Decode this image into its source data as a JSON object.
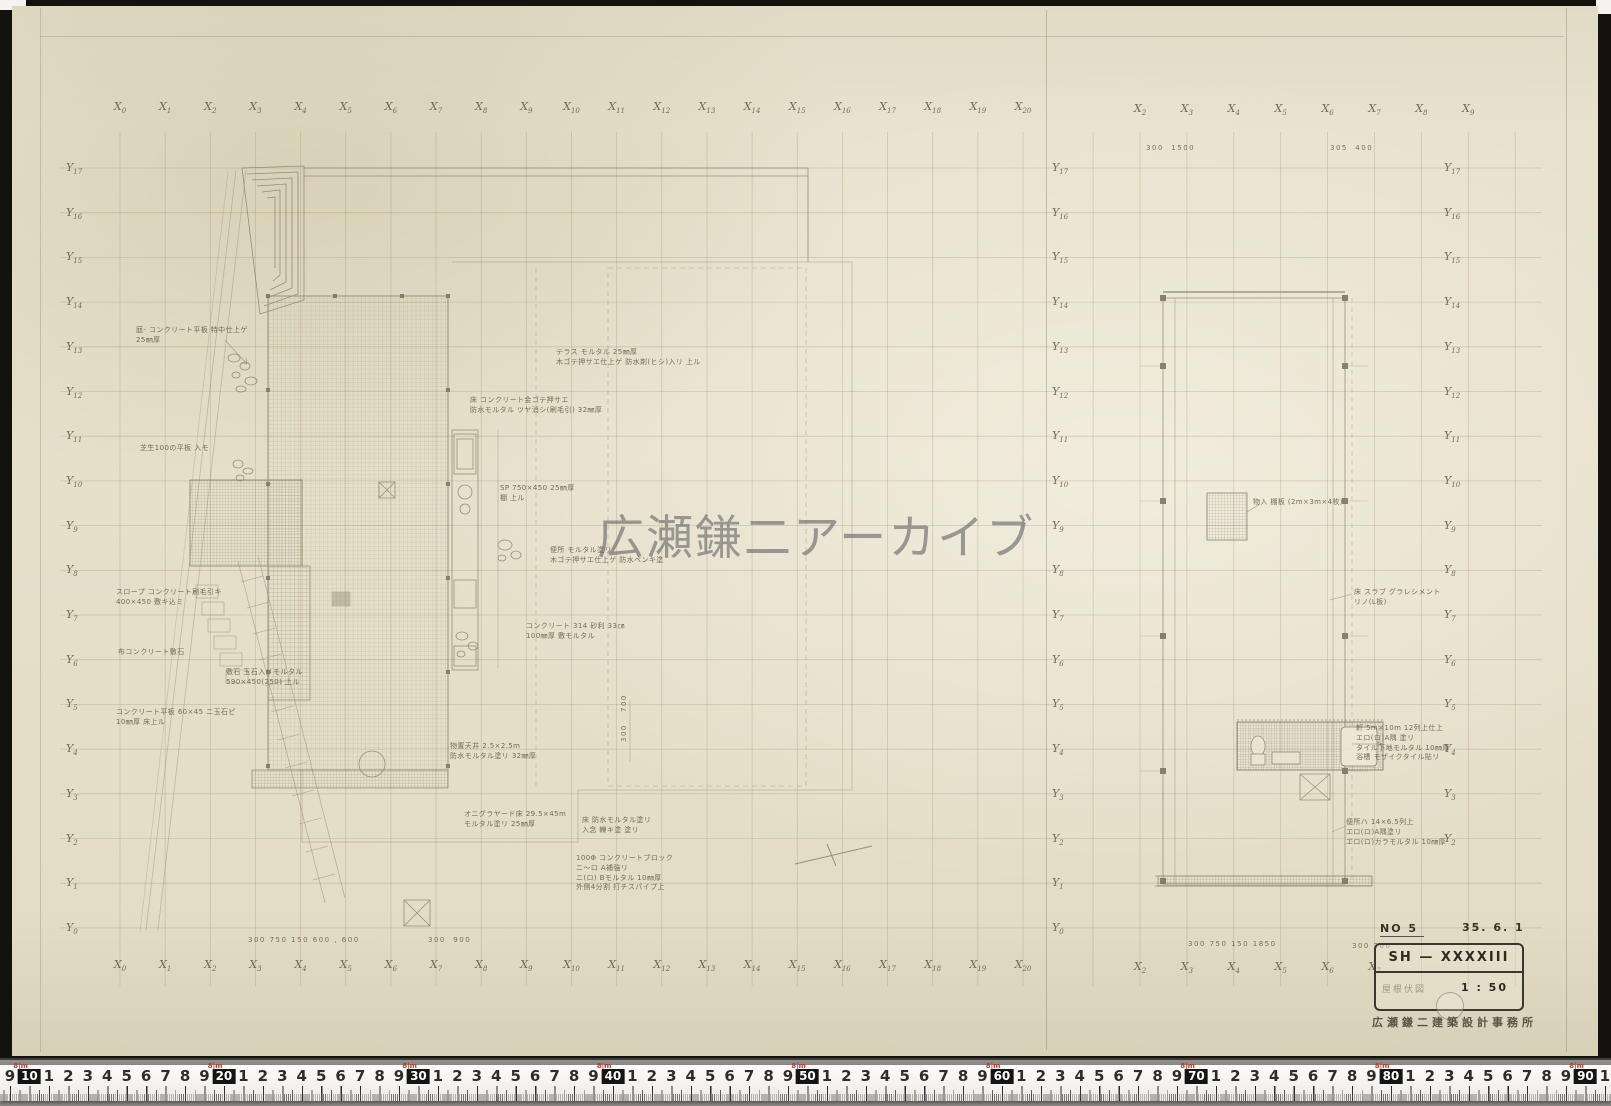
{
  "watermark": "広瀬鎌二アーカイブ",
  "axis": {
    "x_prefix": "X",
    "y_prefix": "Y",
    "left": {
      "numbers": [
        0,
        1,
        2,
        3,
        4,
        5,
        6,
        7,
        8,
        9,
        10,
        11,
        12,
        13,
        14,
        15,
        16,
        17,
        18,
        19,
        20
      ],
      "x0": 120,
      "dx": 45.15,
      "top_y": 100,
      "bot_y": 958
    },
    "right": {
      "top_numbers": [
        2,
        3,
        4,
        5,
        6,
        7,
        8,
        9
      ],
      "bot_numbers": [
        2,
        3,
        4,
        5,
        6,
        7
      ],
      "x0": 1140,
      "dx": 46.9,
      "top_y": 102,
      "bot_y": 960
    },
    "y_rows": {
      "numbers": [
        17,
        16,
        15,
        14,
        13,
        12,
        11,
        10,
        9,
        8,
        7,
        6,
        5,
        4,
        3,
        2,
        1,
        0
      ],
      "y0": 161,
      "dy": 44.7,
      "cols": [
        66,
        1052,
        1444
      ],
      "col_counts": [
        18,
        18,
        16
      ]
    }
  },
  "grid": {
    "v_left": {
      "x0": 120,
      "dx": 45.15,
      "count": 21,
      "y1": 132,
      "y2": 986
    },
    "v_right": {
      "x0": 1093.1,
      "dx": 46.9,
      "count": 10,
      "y1": 132,
      "y2": 986
    },
    "h": {
      "y0": 168,
      "dy": 44.7,
      "count": 18,
      "x1": 60,
      "x2": 1542
    },
    "color": "rgba(150,132,95,0.32)"
  },
  "annotations": [
    {
      "x": 136,
      "y": 326,
      "t": "庭- コンクリート平板 特中仕上ゲ\n25㎜厚"
    },
    {
      "x": 140,
      "y": 444,
      "t": "芝生100の平板 入モ"
    },
    {
      "x": 116,
      "y": 588,
      "t": "スロープ コンクリート刷毛引キ\n400×450 敷キ込ミ"
    },
    {
      "x": 118,
      "y": 648,
      "t": "布コンクリート敷石"
    },
    {
      "x": 226,
      "y": 668,
      "t": "敷石 玉石入リモルタル\n590×450(250) 上ル"
    },
    {
      "x": 116,
      "y": 708,
      "t": "コンクリート平板 60×45 ニ玉石ピ\n10㎜厚 床上ル"
    },
    {
      "x": 556,
      "y": 348,
      "t": "テラス モルタル 25㎜厚\n木ゴテ押サエ仕上ゲ 防水剤(ヒシ)入リ 上ル"
    },
    {
      "x": 470,
      "y": 396,
      "t": "床 コンクリート金ゴテ押サエ\n防水モルタル ツヤ消シ(刷毛引) 32㎜厚"
    },
    {
      "x": 500,
      "y": 484,
      "t": "SP 750×450 25㎜厚\n棚 上ル"
    },
    {
      "x": 550,
      "y": 546,
      "t": "便所 モルタル塗リ\n木ゴテ押サエ仕上ゲ 防水ペンキ塗"
    },
    {
      "x": 526,
      "y": 622,
      "t": "コンクリート 314 砂利 33㎝\n100㎜厚 敷モルタル"
    },
    {
      "x": 450,
      "y": 742,
      "t": "物置天井 2.5×2.5m\n防水モルタル塗リ 32㎜厚"
    },
    {
      "x": 464,
      "y": 810,
      "t": "オニグラヤード床 29.5×45m\nモルタル塗リ 25㎜厚"
    },
    {
      "x": 582,
      "y": 816,
      "t": "床 防水モルタル塗リ\n入念 轢キ塗 塗リ"
    },
    {
      "x": 576,
      "y": 854,
      "t": "100Φ コンクリートブロック\nニ〜ロ A補強リ\nニ(ロ) Bモルタル 10㎜厚\n外側4分割 打チスパイプ上"
    },
    {
      "x": 1253,
      "y": 498,
      "t": "物入 棚板 (2m×3m×4枚)"
    },
    {
      "x": 1354,
      "y": 588,
      "t": "床 スラブ グラレシメント\nリノ(L板)"
    },
    {
      "x": 1356,
      "y": 724,
      "t": "軒 5m×10m 12列上仕上\nエロ(ロ)A隅 塗リ\nタイル下地モルタル 10㎜厚\n浴槽 モザイクタイル貼リ"
    },
    {
      "x": 1346,
      "y": 818,
      "t": "便所ハ 14×6.5列上\nエロ(ロ)A隅塗リ\nエロ(ロ)カラモルタル 10㎜厚"
    }
  ],
  "dimensions": [
    {
      "x": 248,
      "y": 936,
      "t": "300 750 150 600 , 600"
    },
    {
      "x": 428,
      "y": 936,
      "t": "300  900"
    },
    {
      "x": 1146,
      "y": 144,
      "t": "300  1500"
    },
    {
      "x": 1330,
      "y": 144,
      "t": "305  400"
    },
    {
      "x": 1188,
      "y": 940,
      "t": "300 750 150 1850"
    },
    {
      "x": 1352,
      "y": 942,
      "t": "300 200"
    },
    {
      "x": 620,
      "y": 712,
      "t": "700",
      "v": true
    },
    {
      "x": 620,
      "y": 742,
      "t": "300",
      "v": true
    }
  ],
  "titleblock": {
    "no": "NO 5",
    "date": "35. 6. 1",
    "code": "SH — XXXXIII",
    "subtitle": "屋根伏図",
    "scale": "1 : 50",
    "stamp": "広瀬鎌二建築設計事務所"
  },
  "ruler": {
    "start": 9,
    "end": 91,
    "px_per_cm": 19.45,
    "x0": 10,
    "decade_mark": "8|m"
  }
}
